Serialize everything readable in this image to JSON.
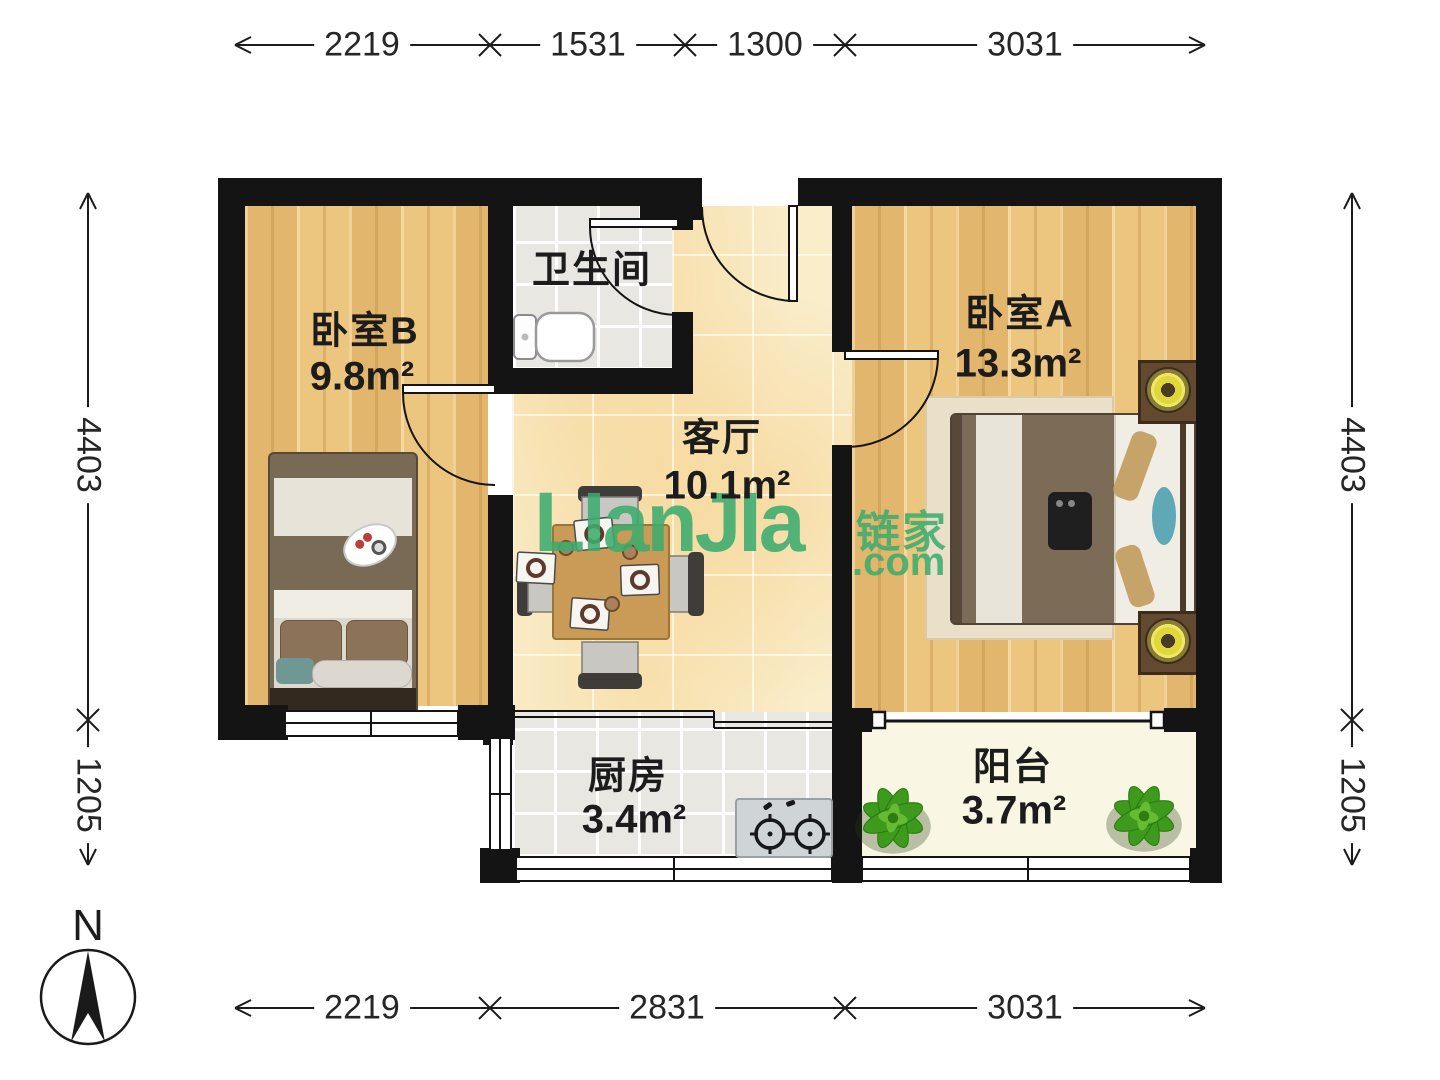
{
  "compass": {
    "label": "N"
  },
  "watermark": {
    "brand": "LIanJIa",
    "brand_cn": "链家",
    "suffix": ".com",
    "color": "#3bac6e"
  },
  "rooms": {
    "bedroom_b": {
      "name": "卧室B",
      "area": "9.8m²"
    },
    "bathroom": {
      "name": "卫生间"
    },
    "living": {
      "name": "客厅",
      "area": "10.1m²"
    },
    "bedroom_a": {
      "name": "卧室A",
      "area": "13.3m²"
    },
    "kitchen": {
      "name": "厨房",
      "area": "3.4m²"
    },
    "balcony": {
      "name": "阳台",
      "area": "3.7m²"
    }
  },
  "dimensions": {
    "top": [
      "2219",
      "1531",
      "1300",
      "3031"
    ],
    "bottom": [
      "2219",
      "2831",
      "3031"
    ],
    "left": [
      "4403",
      "1205"
    ],
    "right": [
      "4403",
      "1205"
    ]
  },
  "colors": {
    "wall": "#141414",
    "wood_floor": "#eac37c",
    "marble_floor": "#f9edca",
    "tile_floor": "#e8e7e2",
    "balcony_floor": "#f9f7e3",
    "watermark_green": "#3bac6e",
    "table_wood": "#c99b56",
    "lamp_yellow": "#e5df3b",
    "plant_green": "#46a31f",
    "blanket_brown": "#7b6b57"
  }
}
